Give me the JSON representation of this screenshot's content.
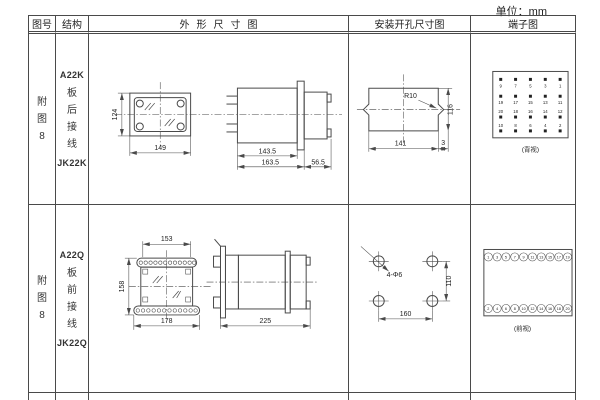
{
  "unit_label": "单位：mm",
  "header": {
    "figure": "图号",
    "structure": "结构",
    "outline": "外形尺寸图",
    "mounting": "安装开孔尺寸图",
    "terminal": "端子图"
  },
  "r1": {
    "figure": "附图8",
    "model": "A22K",
    "wiring": "板后接线",
    "model2": "JK22K",
    "dims": {
      "h": "124",
      "w": "149",
      "d1": "143.5",
      "d2": "163.5",
      "d3": "56.5"
    },
    "mount": {
      "r": "R10",
      "w": "141",
      "off": "3",
      "h": "116"
    },
    "term": {
      "label": "(背视)",
      "g": [
        [
          "9",
          "7",
          "5",
          "3",
          "1"
        ],
        [
          "19",
          "17",
          "15",
          "13",
          "11"
        ],
        [
          "20",
          "18",
          "16",
          "14",
          "12"
        ],
        [
          "10",
          "8",
          "6",
          "4",
          "2"
        ]
      ]
    }
  },
  "r2": {
    "figure": "附图8",
    "model": "A22Q",
    "wiring": "板前接线",
    "model2": "JK22Q",
    "dims": {
      "wt": "153",
      "h": "158",
      "wb": "178",
      "d": "225"
    },
    "mount": {
      "holes": "4-Φ6",
      "w": "160",
      "h": "110"
    },
    "term": {
      "label": "(前视)",
      "top": [
        "1",
        "3",
        "5",
        "7",
        "9",
        "11",
        "13",
        "15",
        "17",
        "19"
      ],
      "bot": [
        "2",
        "4",
        "6",
        "8",
        "10",
        "12",
        "14",
        "16",
        "18",
        "20"
      ]
    }
  }
}
